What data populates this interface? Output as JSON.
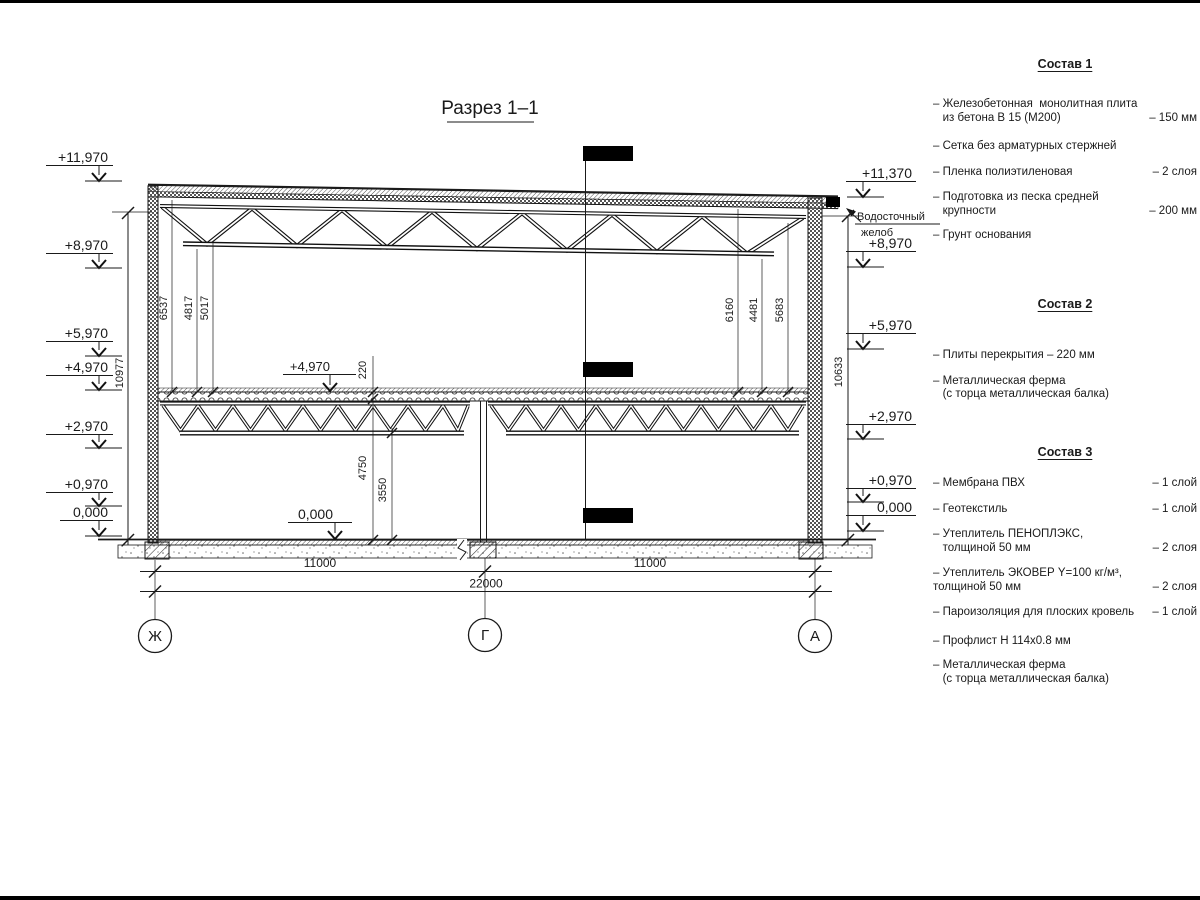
{
  "title": "Разрез 1–1",
  "drawing": {
    "elev_left": [
      "+11,970",
      "+8,970",
      "+5,970",
      "+4,970",
      "+2,970",
      "+0,970",
      "0,000"
    ],
    "elev_right": [
      "+11,370",
      "+8,970",
      "+5,970",
      "+2,970",
      "+0,970",
      "0,000"
    ],
    "elev_mid_floor": "+4,970",
    "elev_mid_zero": "0,000",
    "gutter_line1": "Водосточный",
    "gutter_line2": "желоб",
    "dim_total_left": "10977",
    "dim_total_right": "10633",
    "dims_int_left": [
      "6537",
      "4817",
      "5017"
    ],
    "dims_int_right": [
      "6160",
      "4481",
      "5683"
    ],
    "dim_slab": "220",
    "dim_floor1": "4750",
    "dim_floor2": "3550",
    "dim_span_left": "11000",
    "dim_span_right": "11000",
    "dim_span_total": "22000",
    "axis_left": "Ж",
    "axis_mid": "Г",
    "axis_right": "А"
  },
  "compositions": [
    {
      "title": "Состав 1",
      "items": [
        {
          "text": "– Железобетонная  монолитная плита\n   из бетона В 15 (М200)",
          "qty": "– 150 мм"
        },
        {
          "text": "– Сетка без арматурных стержней",
          "qty": ""
        },
        {
          "text": "– Пленка полиэтиленовая",
          "qty": "– 2 слоя"
        },
        {
          "text": "– Подготовка из песка средней\n   крупности",
          "qty": "– 200 мм"
        },
        {
          "text": "– Грунт основания",
          "qty": ""
        }
      ]
    },
    {
      "title": "Состав 2",
      "items": [
        {
          "text": "– Плиты перекрытия – 220 мм",
          "qty": ""
        },
        {
          "text": "– Металлическая ферма\n   (с торца металлическая балка)",
          "qty": ""
        }
      ]
    },
    {
      "title": "Состав 3",
      "items": [
        {
          "text": "– Мембрана ПВХ",
          "qty": "– 1 слой"
        },
        {
          "text": "– Геотекстиль",
          "qty": "– 1 слой"
        },
        {
          "text": "– Утеплитель ПЕНОПЛЭКС,\n   толщиной 50 мм",
          "qty": "– 2 слоя"
        },
        {
          "text": "– Утеплитель ЭКОВЕР Y=100 кг/м³,\nтолщиной 50 мм",
          "qty": "– 2 слоя"
        },
        {
          "text": "– Пароизоляция для плоских кровель",
          "qty": "– 1 слой"
        },
        {
          "text": "– Профлист Н 114х0.8 мм",
          "qty": ""
        },
        {
          "text": "– Металлическая ферма\n   (с торца металлическая балка)",
          "qty": ""
        }
      ]
    }
  ]
}
